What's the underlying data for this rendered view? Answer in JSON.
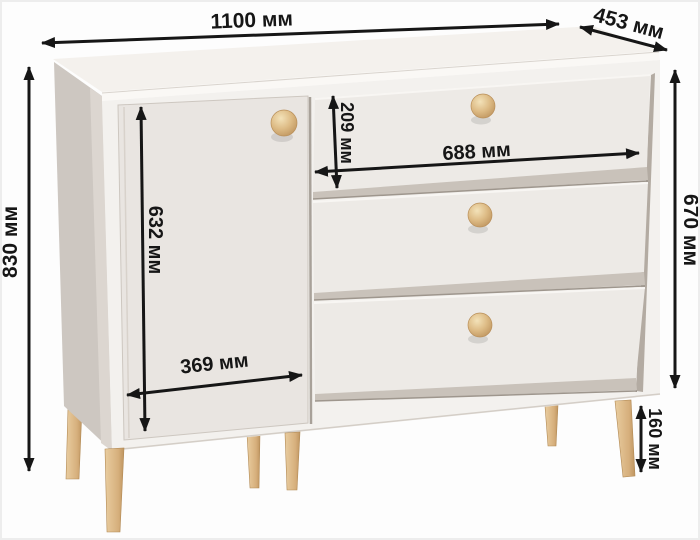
{
  "diagram": {
    "type": "furniture-dimension-diagram",
    "subject": "chest-of-drawers with door, three drawers and wooden legs",
    "unit": "мм",
    "dimensions": {
      "width": {
        "value": 1100,
        "label": "1100 мм"
      },
      "depth": {
        "value": 453,
        "label": "453 мм"
      },
      "height": {
        "value": 830,
        "label": "830 мм"
      },
      "body_height": {
        "value": 670,
        "label": "670 мм"
      },
      "door_height": {
        "value": 632,
        "label": "632 мм"
      },
      "door_width": {
        "value": 369,
        "label": "369 мм"
      },
      "top_drawer_height": {
        "value": 209,
        "label": "209 мм"
      },
      "drawer_width": {
        "value": 688,
        "label": "688 мм"
      },
      "leg_height": {
        "value": 160,
        "label": "160 мм"
      }
    }
  },
  "colors": {
    "background": "#fdfdfd",
    "arrow": "#161616",
    "text": "#161616",
    "top_face": "#f4f1ed",
    "top_edge": "#faf8f5",
    "side_panel": "#cdc7c1",
    "front_face": "#f3f1ee",
    "door": "#e9e5e1",
    "drawer_front": "#edeae6",
    "drawer_reveal": "#c9c2ba",
    "seam": "#9e968d",
    "interior_shadow": "#b3aba2",
    "knob_wood": "#ddbb85",
    "leg_wood": "#d9b383"
  }
}
